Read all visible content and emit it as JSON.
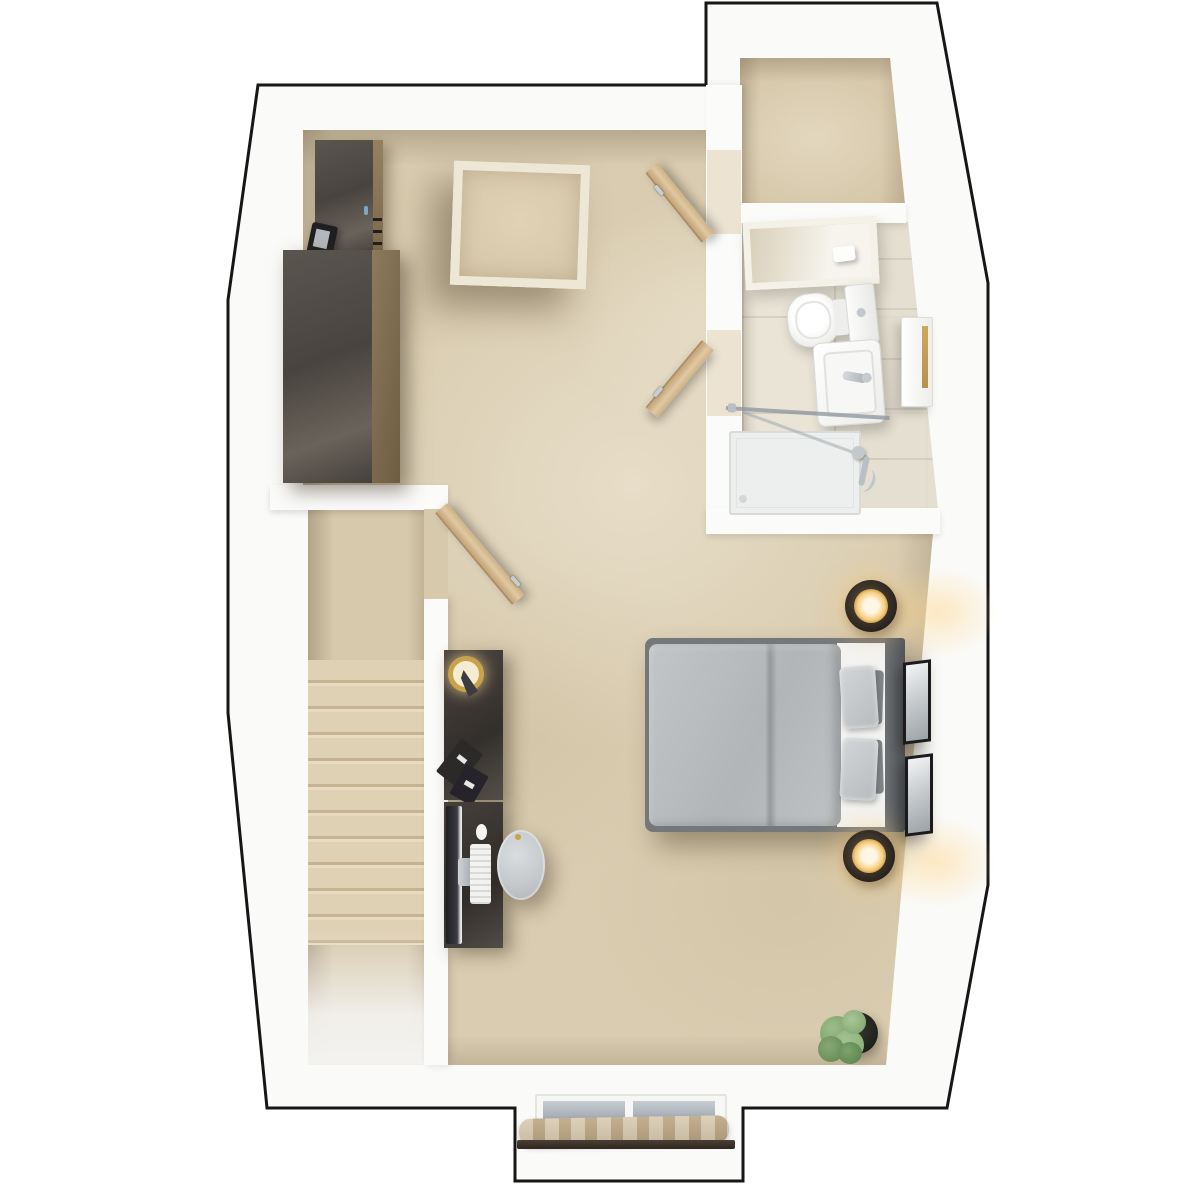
{
  "scene": {
    "type": "floor-plan-3d-top-view",
    "background": "#ffffff",
    "outline_color": "#161616"
  },
  "palette": {
    "wall": "#fbfbfa",
    "carpet": "#d9ccb0",
    "carpet_shadow": "#c6b392",
    "bath_tile": "#e9e4d6",
    "wood_dark": "#49443f",
    "wood_side_brown": "#8d7a5c",
    "door_wood": "#d9c199",
    "duvet_gray": "#b9bcbe",
    "bed_frame_gray": "#75787b",
    "sheet_white": "#f3f3f1",
    "pillow_light": "#c3c6c8",
    "cushion_dark": "#83878b",
    "lamp_glow_gold": "#f8cd7c",
    "brass_gold": "#c9a24b",
    "chrome": "#c3c8cd",
    "window_glass": "#aab2b9",
    "curtain_beige": "#c4b192",
    "rod_brown": "#3a3027",
    "plant_green": "#86a876",
    "chair_gray": "#ccd0d2"
  },
  "rooms": [
    {
      "id": "main-room",
      "floor_finish": "beige carpet",
      "contents": [
        "wardrobe-tall",
        "wardrobe-wide",
        "tablet-on-floor",
        "skylight",
        "sideboard-with-lamp",
        "desk-with-computer",
        "desk-chair",
        "double-bed",
        "nightstand-lamp-top",
        "nightstand-lamp-bottom",
        "wall-art-frame-1",
        "wall-art-frame-2",
        "potted-plant",
        "roof-window-with-curtain"
      ]
    },
    {
      "id": "storage-room",
      "floor_finish": "beige carpet",
      "contents": []
    },
    {
      "id": "bathroom",
      "floor_finish": "cream tile",
      "contents": [
        "mirror-with-shelf",
        "toilet",
        "washbasin",
        "wall-cabinet",
        "walk-in-shower"
      ]
    },
    {
      "id": "stairwell",
      "floor_finish": "carpeted stairs descending",
      "contents": [
        "staircase"
      ]
    }
  ],
  "doors": [
    {
      "id": "stairwell-door",
      "material": "light wood",
      "state": "open"
    },
    {
      "id": "storage-room-door",
      "material": "light wood",
      "state": "open"
    },
    {
      "id": "bathroom-door",
      "material": "light wood",
      "state": "open"
    }
  ]
}
